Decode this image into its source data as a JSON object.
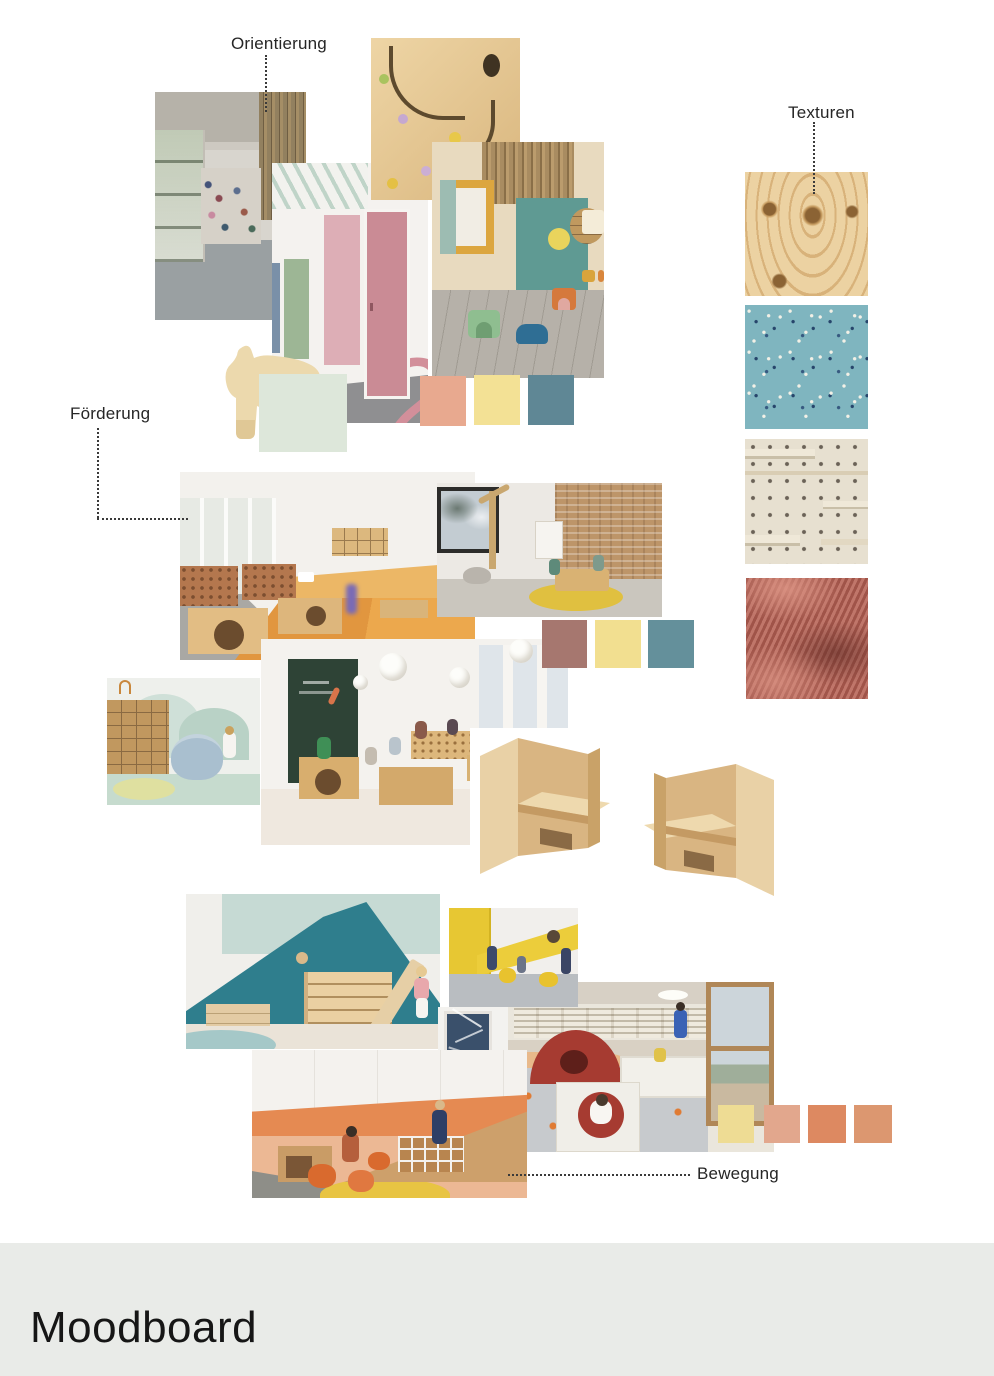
{
  "title": "Moodboard",
  "labels": {
    "orientierung": "Orientierung",
    "texturen": "Texturen",
    "foerderung": "Förderung",
    "bewegung": "Bewegung"
  },
  "palettes": {
    "room_concept": [
      "#E8A98F",
      "#F3E195",
      "#5F8795"
    ],
    "material_concept": [
      "#A6776F",
      "#F2DF90",
      "#64909B"
    ],
    "movement_concept": [
      "#EEDC94",
      "#E2A78D",
      "#DD8961",
      "#DC9770"
    ]
  },
  "textures": [
    {
      "name": "plywood",
      "base": "#ECD2A2"
    },
    {
      "name": "blue-speckled-linoleum",
      "base": "#7FB5BF"
    },
    {
      "name": "pegboard-shelving",
      "base": "#E7E0D0"
    },
    {
      "name": "rust-corduroy-fabric",
      "base": "#B4675C"
    }
  ],
  "images": [
    {
      "id": "corridor-coats",
      "alt": "Kindergarten corridor with coat racks, window front and wood slat wall"
    },
    {
      "id": "marble-run-wall",
      "alt": "Plywood marble run wall panel with colored balls"
    },
    {
      "id": "pink-door-corridor",
      "alt": "Hallway with pink door, green doors and large numeral 2",
      "numeral": "2"
    },
    {
      "id": "teal-playroom",
      "alt": "Playroom with teal wall, round wooden window and animal stools"
    },
    {
      "id": "wooden-horse",
      "alt": "Wooden toy horse"
    },
    {
      "id": "orange-floor-classroom",
      "alt": "Group room with orange floor, cork panels and plywood play tables"
    },
    {
      "id": "brick-wall-room",
      "alt": "Playroom with brick wall and children at wooden table on round yellow rug"
    },
    {
      "id": "washroom",
      "alt": "Washroom with plywood drawer cabinet and round blue basin"
    },
    {
      "id": "chalkboard-classroom",
      "alt": "Classroom with chalkboard wall, paper pendant lamps and children at plywood furniture"
    },
    {
      "id": "cube-chair-left",
      "alt": "Wooden cube chair"
    },
    {
      "id": "cube-chair-right",
      "alt": "Wooden cube chair"
    },
    {
      "id": "teal-climbing-corner",
      "alt": "Play corner with teal climbing wedge, shelf steps and slide"
    },
    {
      "id": "yellow-movement-room",
      "alt": "Movement room with yellow wall band and yellow foam cylinders"
    },
    {
      "id": "winter-window",
      "alt": "Window with snowy winter branches"
    },
    {
      "id": "orange-ramp-landscape",
      "alt": "Play landscape with wooden ramp, drawer boxes and orange pouffes"
    },
    {
      "id": "ball-pit-room",
      "alt": "Movement room with ball pit, red play cave, crawl cube and mountain window"
    }
  ]
}
